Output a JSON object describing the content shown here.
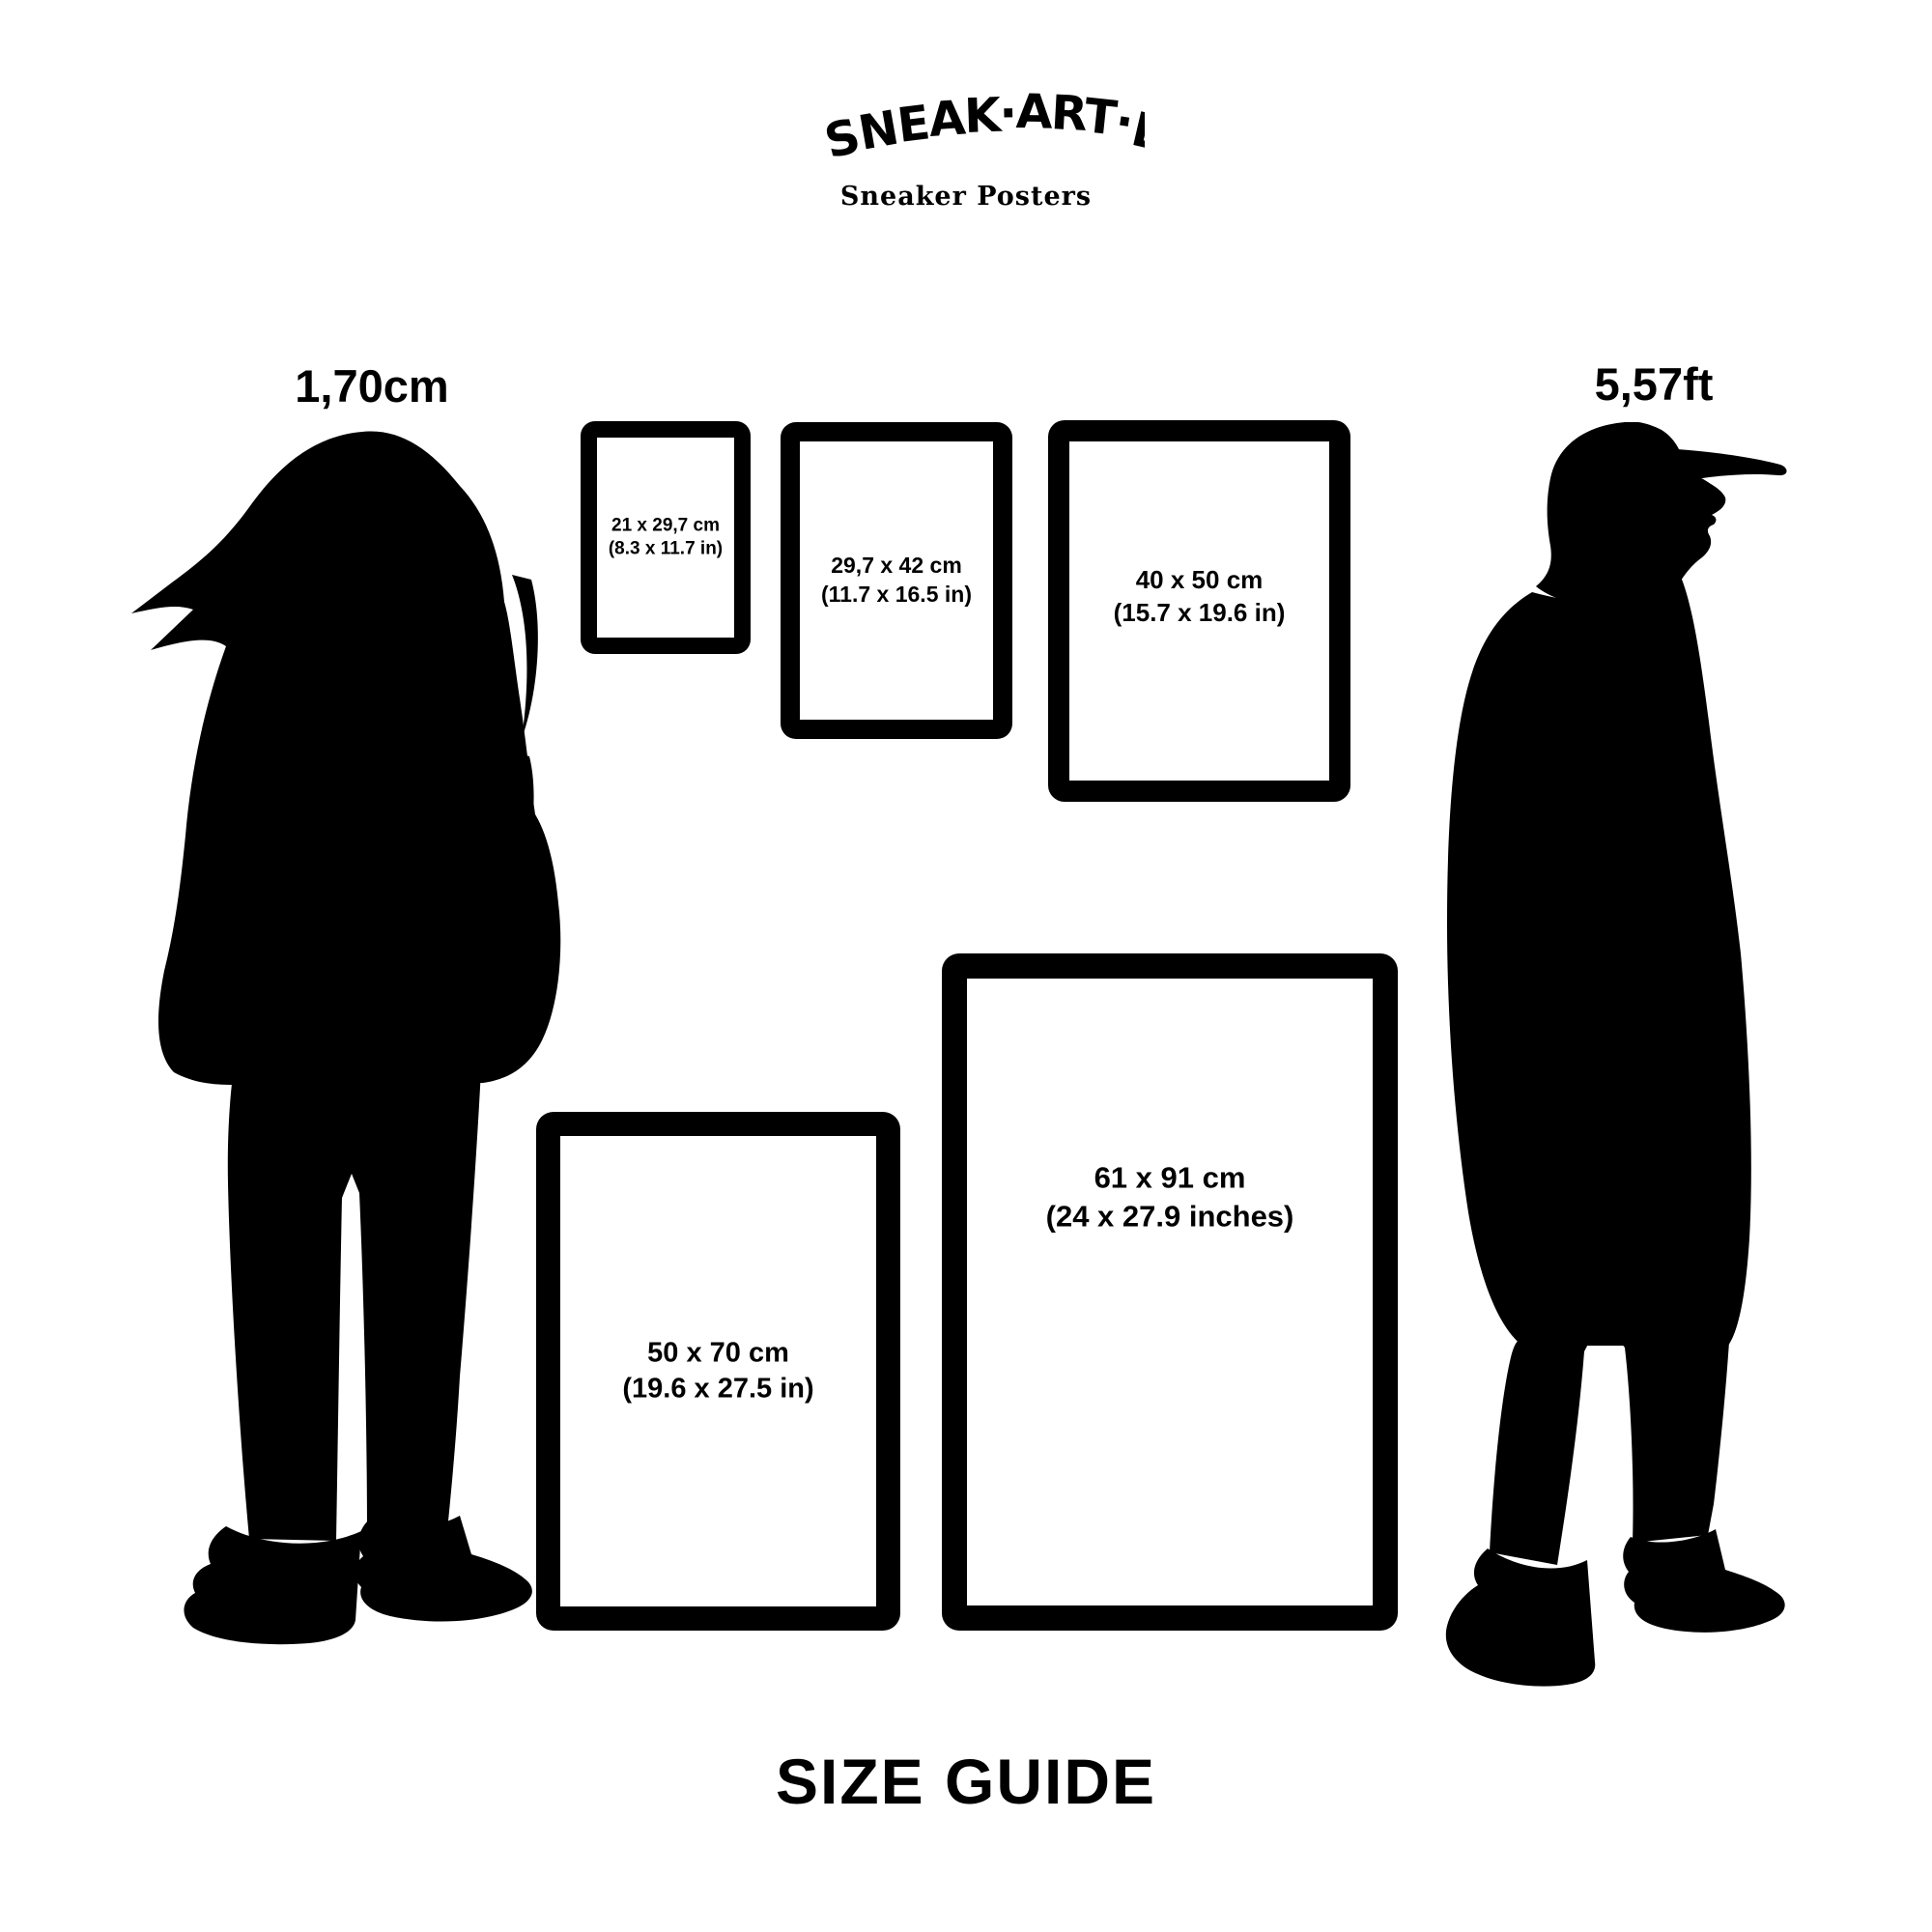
{
  "brand": {
    "logo_text": "SNEAK·ART·EL",
    "tagline": "Sneaker Posters"
  },
  "page_title": "SIZE GUIDE",
  "figures": {
    "woman": {
      "height_label": "1,70cm"
    },
    "man": {
      "height_label": "5,57ft"
    }
  },
  "frames": [
    {
      "cm_label": "21 x 29,7 cm",
      "in_label": "(8.3 x 11.7 in)"
    },
    {
      "cm_label": "29,7 x 42 cm",
      "in_label": "(11.7 x 16.5 in)"
    },
    {
      "cm_label": "40 x 50 cm",
      "in_label": "(15.7 x 19.6 in)"
    },
    {
      "cm_label": "50 x 70 cm",
      "in_label": "(19.6 x 27.5 in)"
    },
    {
      "cm_label": "61 x 91 cm",
      "in_label": "(24 x 27.9 inches)"
    }
  ],
  "colors": {
    "ink": "#000000",
    "background": "#ffffff"
  }
}
